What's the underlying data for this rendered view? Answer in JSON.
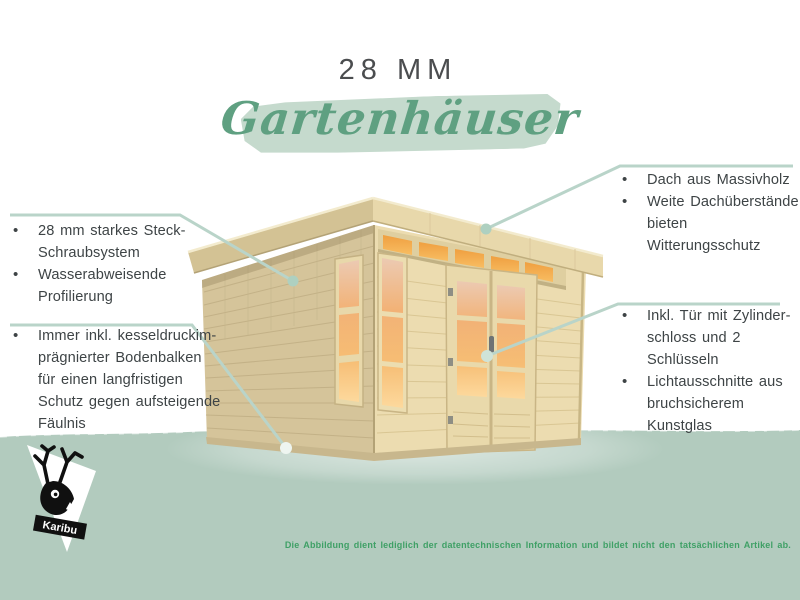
{
  "glyphs": {
    "bullet": "•"
  },
  "header": {
    "size_label": "28 MM",
    "title": "Gartenhäuser"
  },
  "features": {
    "left_top": [
      "28 mm starkes Steck-\nSchraubsystem",
      "Wasserabweisende\nProfilierung"
    ],
    "left_bottom": [
      "Immer inkl. kesseldruckim-\nprägnierter Bodenbalken\nfür einen langfristigen\nSchutz gegen aufsteigende\nFäulnis"
    ],
    "right_top": [
      "Dach aus Massivholz",
      "Weite Dachüberstände\nbieten Witterungsschutz"
    ],
    "right_bottom": [
      "Inkl. Tür mit Zylinder-\nschloss und 2 Schlüsseln",
      "Lichtausschnitte aus\nbruchsicherem Kunstglas"
    ]
  },
  "footer": {
    "disclaimer": "Die Abbildung dient lediglich der datentechnischen Information und bildet nicht den tatsächlichen Artikel ab."
  },
  "logo": {
    "brand": "Karibu"
  },
  "colors": {
    "script_green": "#5fa081",
    "brush_background": "#c5dacd",
    "callout_line": "#b9d4c9",
    "ground_green": "#b2cbbe",
    "text_dark": "#3e4446",
    "disclaimer_green": "#3fa066",
    "wood_front": "#ecdcb0",
    "wood_side": "#d5c49a",
    "glass_orange": "#f4b368"
  }
}
